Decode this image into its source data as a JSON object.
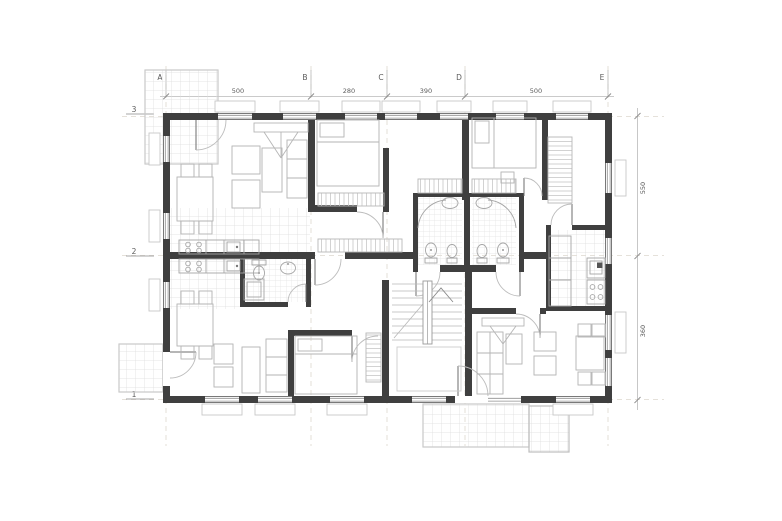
{
  "drawing": {
    "title": "apartment-building-floor-plan",
    "grid_columns": [
      "A",
      "B",
      "C",
      "D",
      "E"
    ],
    "grid_rows": [
      "3",
      "2",
      "1"
    ],
    "dimensions_top": [
      "500",
      "280",
      "390",
      "500"
    ],
    "dimensions_right": [
      "550",
      "360"
    ],
    "colors": {
      "wall": "#3f3f3f",
      "furniture_line": "#b3b3b3",
      "dimension_line": "#b9b9b9",
      "tile_line": "#dedede",
      "text": "#5c5c5c"
    }
  }
}
